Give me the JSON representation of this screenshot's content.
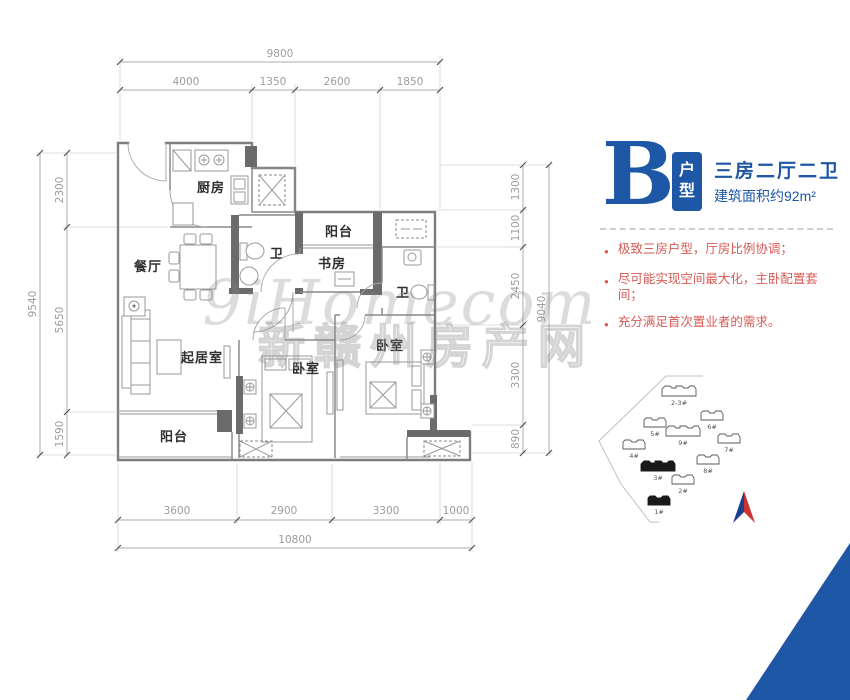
{
  "header": {
    "plan_letter": "B",
    "badge_chars": [
      "户",
      "型"
    ],
    "title": "三房二厅二卫",
    "area": "建筑面积约92m²"
  },
  "features": {
    "items": [
      "极致三房户型，厅房比例协调；",
      "尽可能实现空间最大化，主卧配置套间；",
      "充分满足首次置业者的需求。"
    ]
  },
  "watermark": {
    "line1": "9iHomecom",
    "line2": "新赣州房产网"
  },
  "plan": {
    "rooms": {
      "kitchen": "厨房",
      "dining": "餐厅",
      "bath1": "卫",
      "balcony_top": "阳台",
      "study": "书房",
      "bath2": "卫",
      "living": "起居室",
      "bedroom_mid": "卧室",
      "bedroom_right": "卧室",
      "balcony_bottom": "阳台"
    },
    "dims": {
      "top": {
        "total": "9800",
        "segs": [
          "4000",
          "1350",
          "2600",
          "1850"
        ]
      },
      "left": {
        "total": "9540",
        "segs": [
          "2300",
          "5650",
          "1590"
        ]
      },
      "right": {
        "total": "9040",
        "segs": [
          "1300",
          "1100",
          "2450",
          "3300",
          "890"
        ]
      },
      "bottom": {
        "total": "10800",
        "segs": [
          "3600",
          "2900",
          "3300",
          "1000"
        ]
      }
    }
  },
  "siteplan": {
    "buildings": [
      {
        "label": "2-3#",
        "highlight": false
      },
      {
        "label": "6#",
        "highlight": false
      },
      {
        "label": "5#",
        "highlight": false
      },
      {
        "label": "9#",
        "highlight": false
      },
      {
        "label": "4#",
        "highlight": false
      },
      {
        "label": "7#",
        "highlight": false
      },
      {
        "label": "8#",
        "highlight": false
      },
      {
        "label": "3#",
        "highlight": true
      },
      {
        "label": "2#",
        "highlight": false
      },
      {
        "label": "1#",
        "highlight": true
      }
    ]
  },
  "colors": {
    "accent_blue": "#1d57a6",
    "feature_red": "#d85a55",
    "wall_gray": "#7d7d7d",
    "dim_gray": "#9c9c9c",
    "compass_blue": "#1c3e8e",
    "compass_red": "#c9342e"
  }
}
